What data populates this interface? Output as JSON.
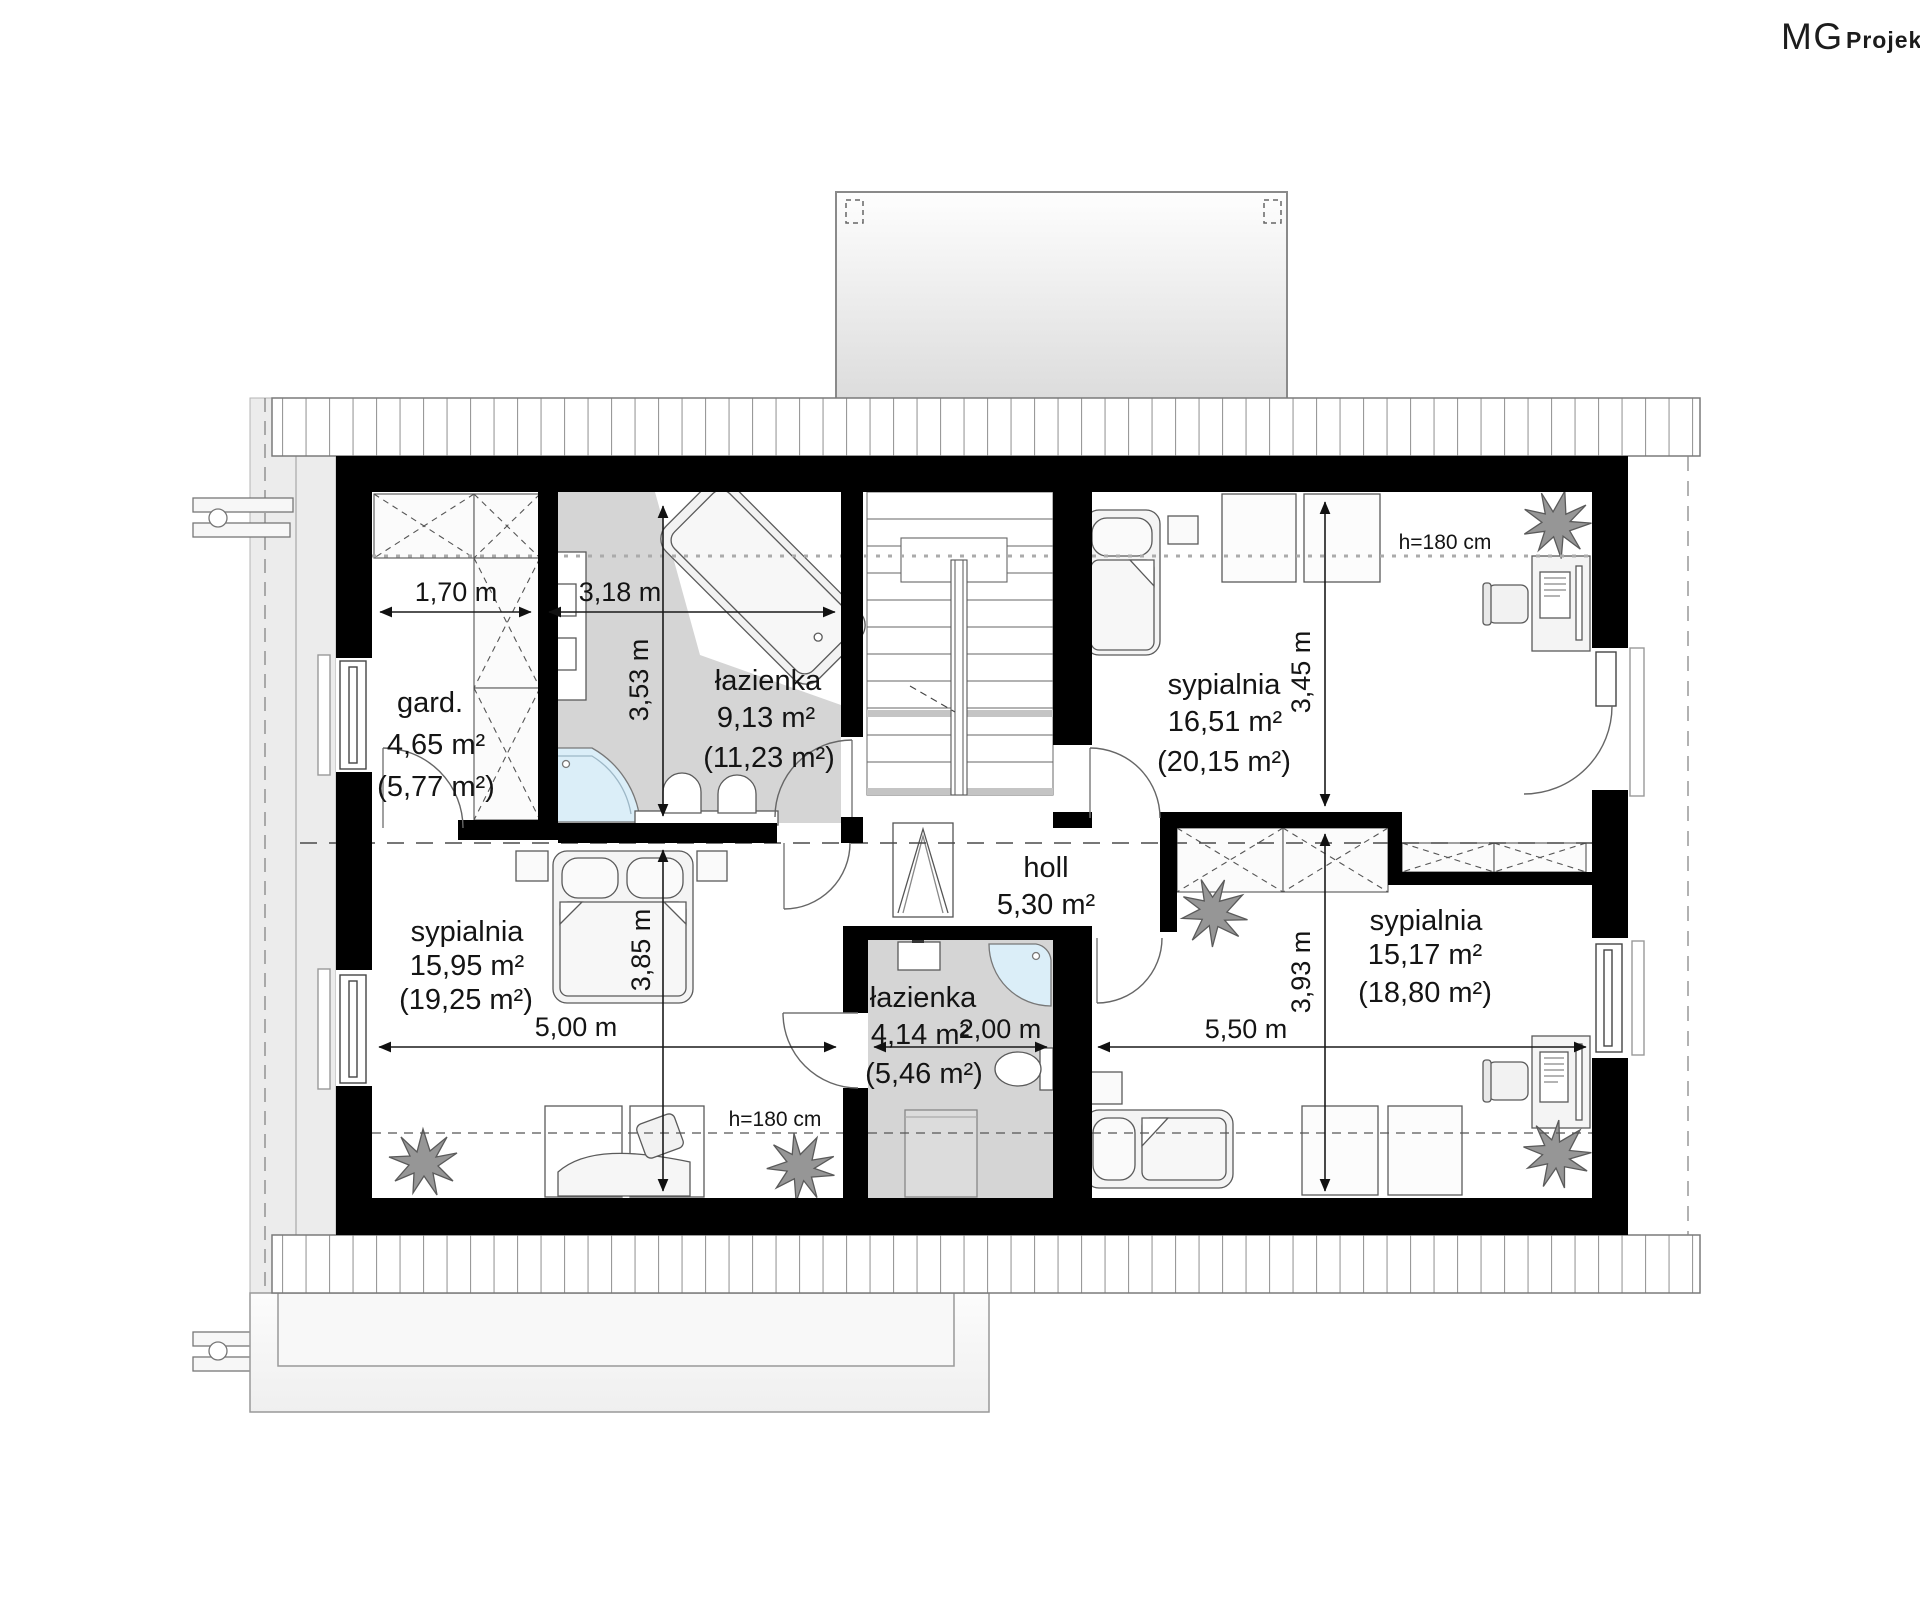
{
  "logo": {
    "mg": "MG",
    "projekt": "Projekt"
  },
  "rooms": {
    "gard": {
      "name": "gard.",
      "area": "4,65 m²",
      "area_total": "(5,77 m²)"
    },
    "bath_top": {
      "name": "łazienka",
      "area": "9,13 m²",
      "area_total": "(11,23 m²)"
    },
    "bed_top_right": {
      "name": "sypialnia",
      "area": "16,51 m²",
      "area_total": "(20,15 m²)"
    },
    "bed_left": {
      "name": "sypialnia",
      "area": "15,95 m²",
      "area_total": "(19,25 m²)"
    },
    "holl": {
      "name": "holl",
      "area": "5,30 m²"
    },
    "bath_bottom": {
      "name": "łazienka",
      "area": "4,14 m²",
      "area_total": "(5,46 m²)"
    },
    "bed_bottom_right": {
      "name": "sypialnia",
      "area": "15,17 m²",
      "area_total": "(18,80 m²)"
    }
  },
  "dimensions": {
    "w_gard": "1,70 m",
    "w_bath_top": "3,18 m",
    "h_bath_top": "3,53 m",
    "h_bed_top_right": "3,45 m",
    "h_bed_left": "3,85 m",
    "h_bed_bottom_right": "3,93 m",
    "w_bed_left": "5,00 m",
    "w_bath_bottom": "2,00 m",
    "w_bed_bottom_right": "5,50 m",
    "knee_wall_top": "h=180 cm",
    "knee_wall_bottom": "h=180 cm"
  },
  "colors": {
    "wall": "#000000",
    "bath_floor": "#d5d5d5",
    "shower_fill": "#dbeef8",
    "roof_line": "#7a7a7a",
    "text": "#141414"
  }
}
